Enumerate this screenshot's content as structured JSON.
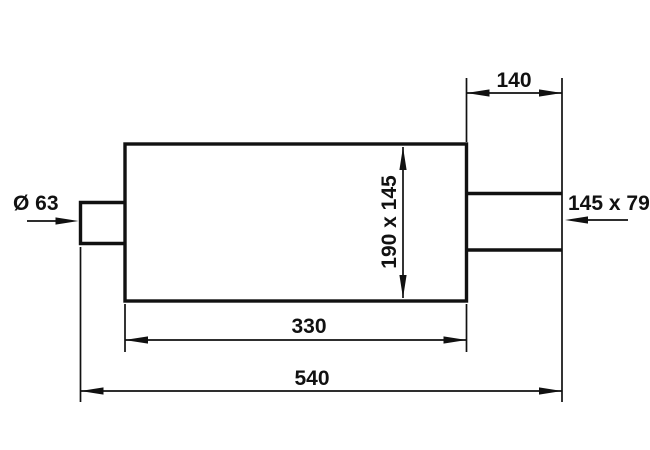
{
  "drawing": {
    "title": "Muffler dimensional drawing",
    "background_color": "#ffffff",
    "line_color": "#111111",
    "labels": {
      "inlet_diameter": "Ø 63",
      "outlet_size": "145 x 79",
      "outlet_length": "140",
      "body_cross_section": "190 x 145",
      "body_length": "330",
      "overall_length": "540"
    }
  }
}
